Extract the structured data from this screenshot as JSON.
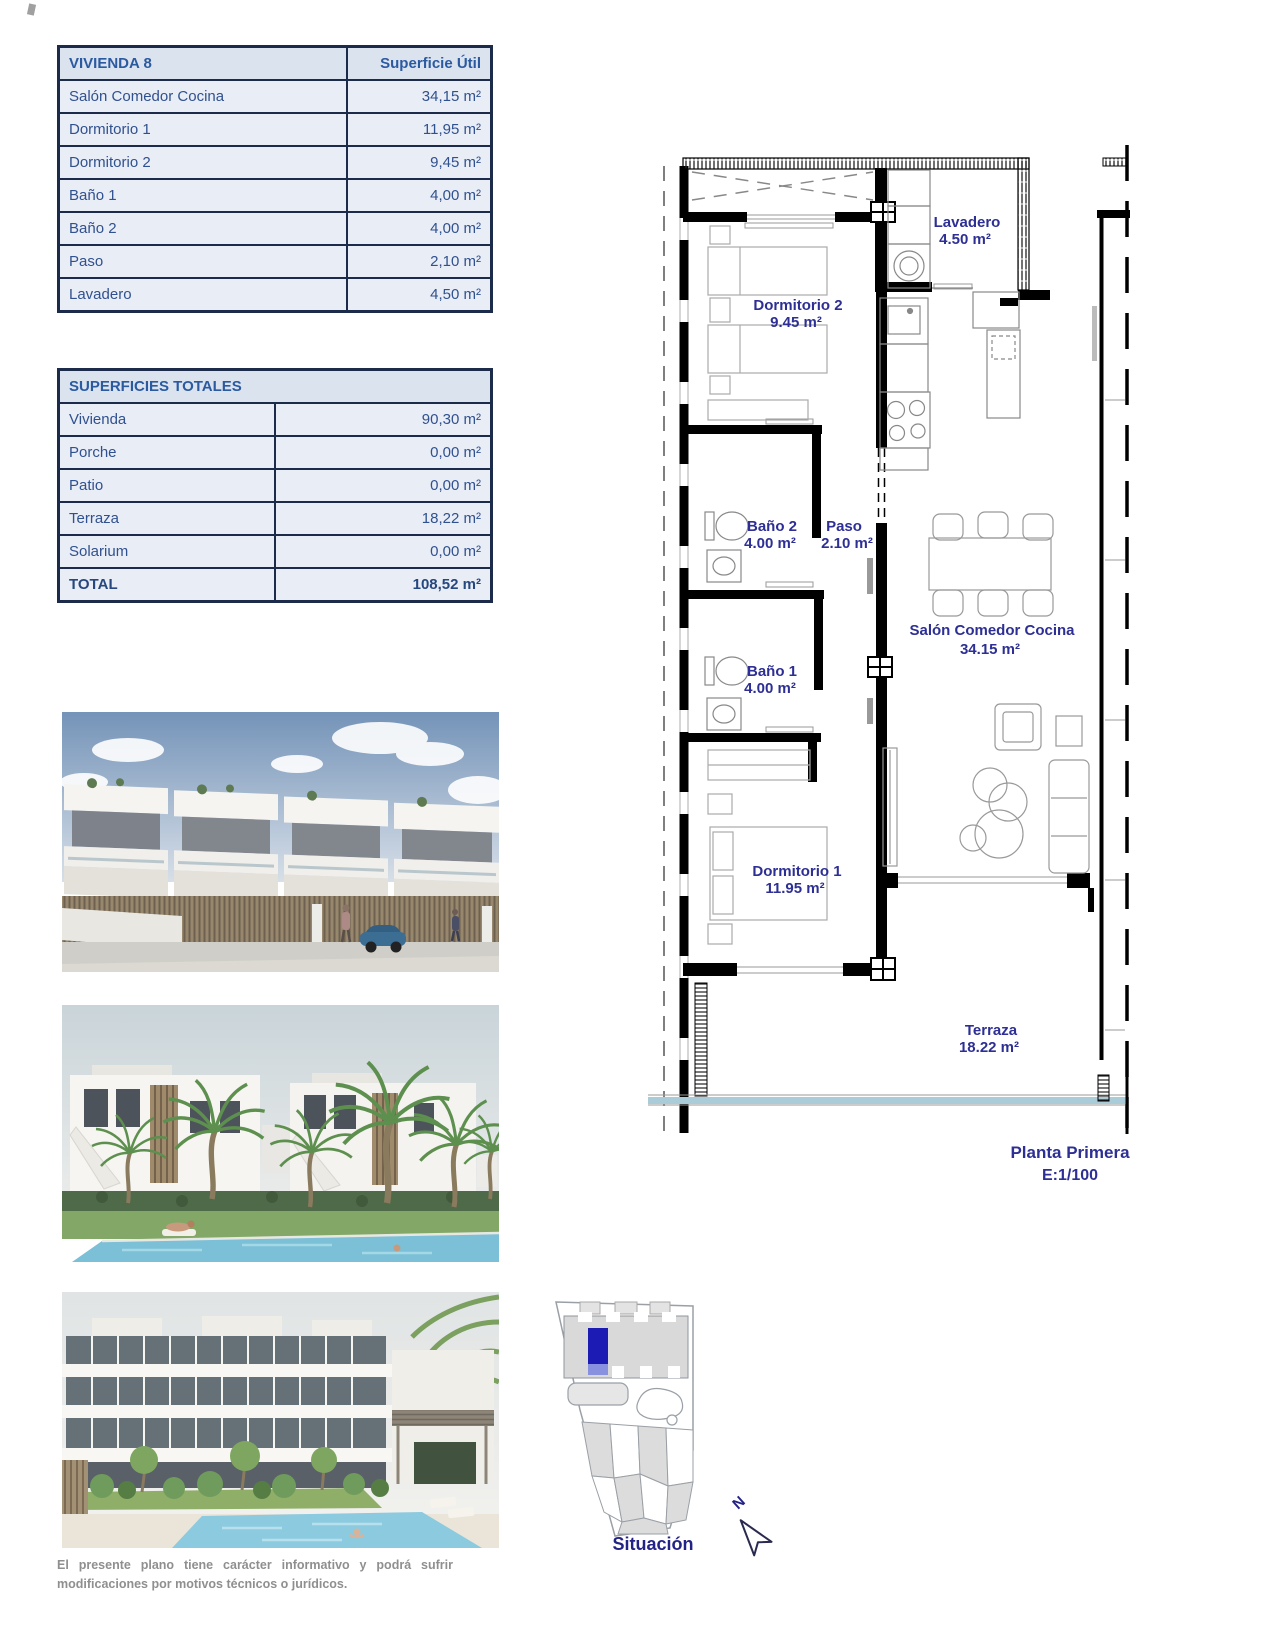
{
  "vivienda_table": {
    "title": "VIVIENDA 8",
    "header_value": "Superficie Útil",
    "rows": [
      {
        "label": "Salón Comedor Cocina",
        "value": "34,15 m²"
      },
      {
        "label": "Dormitorio 1",
        "value": "11,95 m²"
      },
      {
        "label": "Dormitorio 2",
        "value": "9,45 m²"
      },
      {
        "label": "Baño 1",
        "value": "4,00 m²"
      },
      {
        "label": "Baño 2",
        "value": "4,00 m²"
      },
      {
        "label": "Paso",
        "value": "2,10 m²"
      },
      {
        "label": "Lavadero",
        "value": "4,50 m²"
      }
    ]
  },
  "totales_table": {
    "title": "SUPERFICIES TOTALES",
    "rows": [
      {
        "label": "Vivienda",
        "value": "90,30 m²"
      },
      {
        "label": "Porche",
        "value": "0,00 m²"
      },
      {
        "label": "Patio",
        "value": "0,00 m²"
      },
      {
        "label": "Terraza",
        "value": "18,22 m²"
      },
      {
        "label": "Solarium",
        "value": "0,00 m²"
      }
    ],
    "total_label": "TOTAL",
    "total_value": "108,52 m²"
  },
  "floor_plan": {
    "rooms": {
      "lavadero": {
        "name": "Lavadero",
        "area": "4.50 m²"
      },
      "dormitorio2": {
        "name": "Dormitorio 2",
        "area": "9.45 m²"
      },
      "bano2": {
        "name": "Baño 2",
        "area": "4.00 m²"
      },
      "paso": {
        "name": "Paso",
        "area": "2.10 m²"
      },
      "bano1": {
        "name": "Baño 1",
        "area": "4.00 m²"
      },
      "salon": {
        "name": "Salón Comedor Cocina",
        "area": "34.15 m²"
      },
      "dormitorio1": {
        "name": "Dormitorio 1",
        "area": "11.95 m²"
      },
      "terraza": {
        "name": "Terraza",
        "area": "18.22 m²"
      }
    },
    "caption_title": "Planta Primera",
    "caption_scale": "E:1/100"
  },
  "site_plan": {
    "label": "Situación",
    "north_label": "N"
  },
  "document": {
    "disclaimer": "El presente plano tiene carácter informativo y podrá sufrir modificaciones por motivos técnicos o jurídicos."
  },
  "colors": {
    "accent_navy": "#2d2f94",
    "table_text": "#30518f",
    "table_header_text": "#2b5aa0",
    "table_border": "#1c2b4a",
    "table_header_bg": "#dbe3ef",
    "table_row_bg": "#e9edf5",
    "balustrade_blue": "#a9ccd8",
    "site_highlight_blue": "#1c1cb4"
  }
}
